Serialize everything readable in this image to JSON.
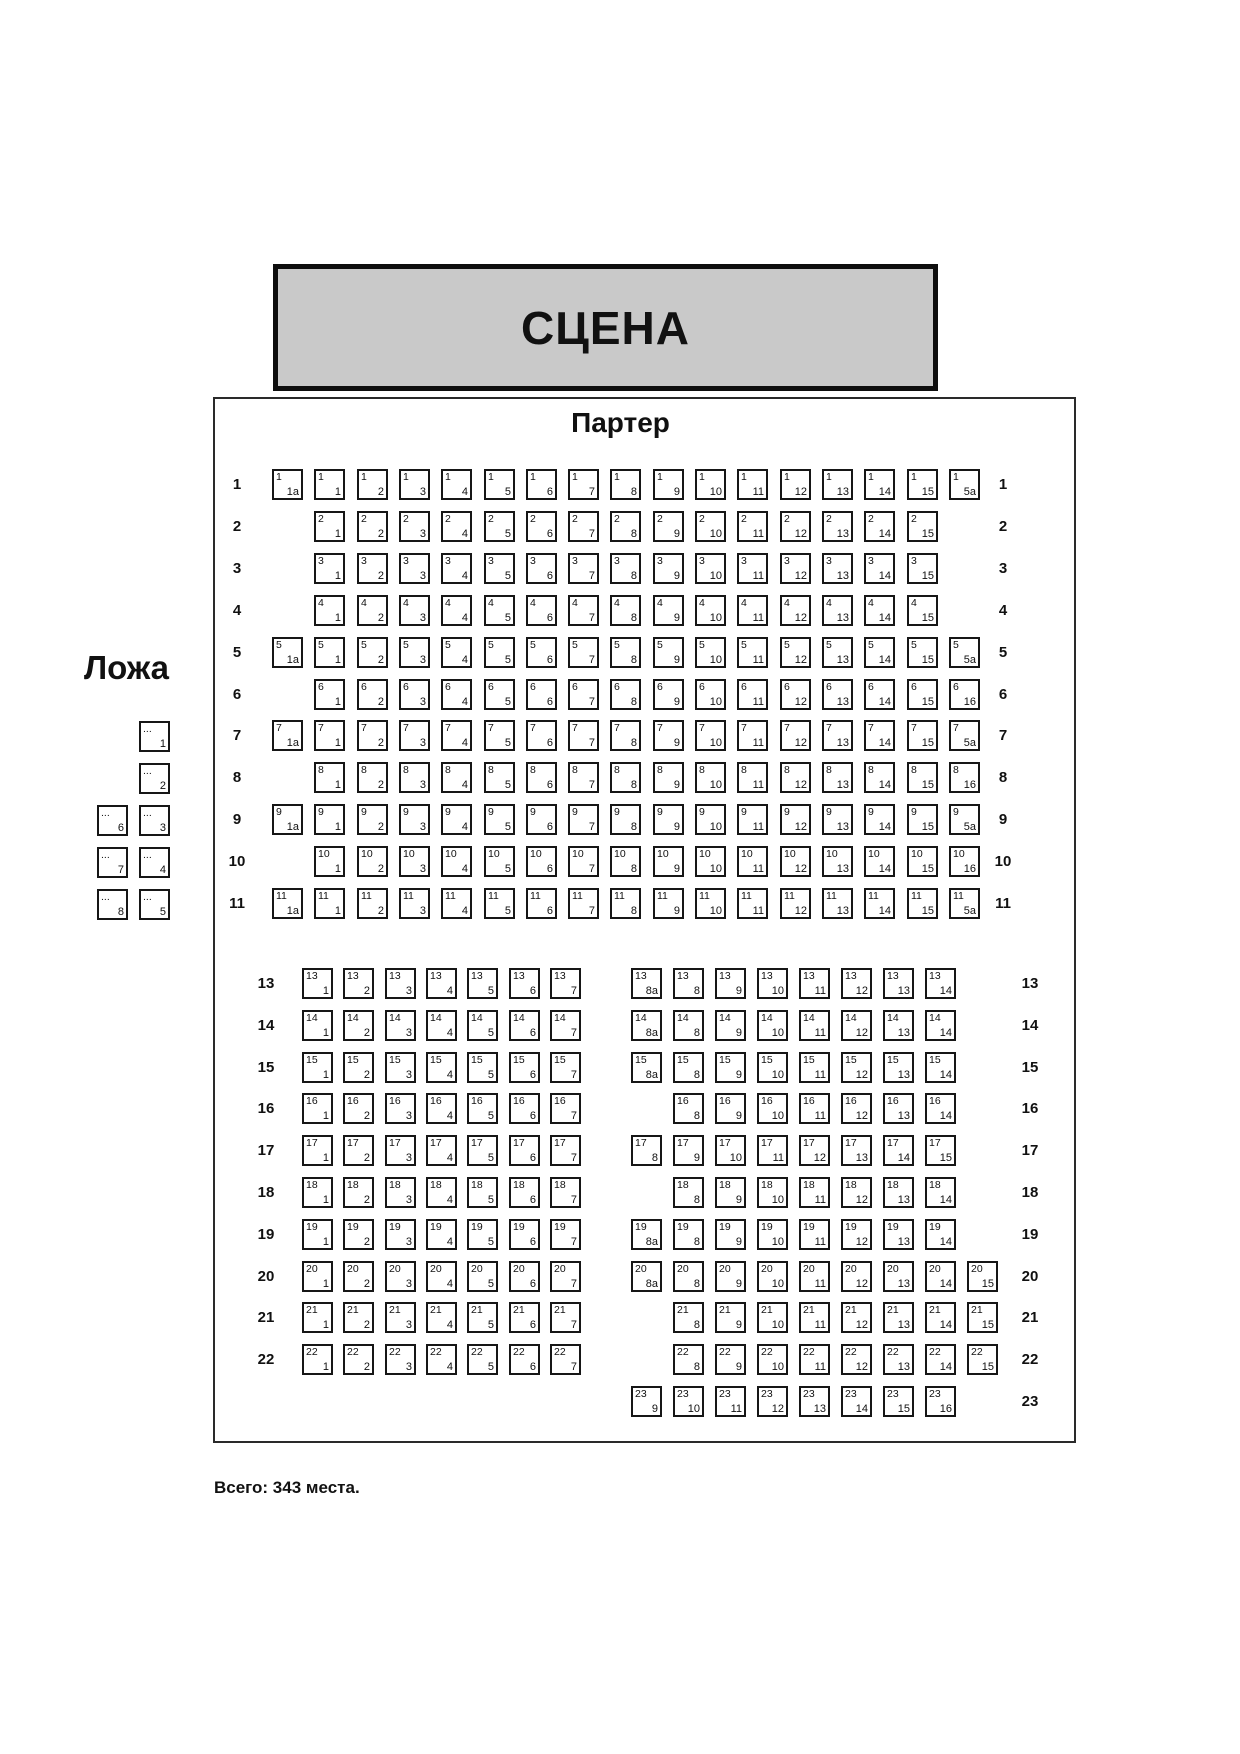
{
  "stage": {
    "label": "СЦЕНА"
  },
  "parterre": {
    "title": "Партер",
    "upper_rows": [
      {
        "label": "1",
        "start": 0,
        "seats": [
          "1a",
          "1",
          "2",
          "3",
          "4",
          "5",
          "6",
          "7",
          "8",
          "9",
          "10",
          "11",
          "12",
          "13",
          "14",
          "15",
          "5a"
        ]
      },
      {
        "label": "2",
        "start": 1,
        "seats": [
          "1",
          "2",
          "3",
          "4",
          "5",
          "6",
          "7",
          "8",
          "9",
          "10",
          "11",
          "12",
          "13",
          "14",
          "15"
        ]
      },
      {
        "label": "3",
        "start": 1,
        "seats": [
          "1",
          "2",
          "3",
          "4",
          "5",
          "6",
          "7",
          "8",
          "9",
          "10",
          "11",
          "12",
          "13",
          "14",
          "15"
        ]
      },
      {
        "label": "4",
        "start": 1,
        "seats": [
          "1",
          "2",
          "3",
          "4",
          "5",
          "6",
          "7",
          "8",
          "9",
          "10",
          "11",
          "12",
          "13",
          "14",
          "15"
        ]
      },
      {
        "label": "5",
        "start": 0,
        "seats": [
          "1a",
          "1",
          "2",
          "3",
          "4",
          "5",
          "6",
          "7",
          "8",
          "9",
          "10",
          "11",
          "12",
          "13",
          "14",
          "15",
          "5a"
        ]
      },
      {
        "label": "6",
        "start": 1,
        "seats": [
          "1",
          "2",
          "3",
          "4",
          "5",
          "6",
          "7",
          "8",
          "9",
          "10",
          "11",
          "12",
          "13",
          "14",
          "15",
          "16"
        ]
      },
      {
        "label": "7",
        "start": 0,
        "seats": [
          "1a",
          "1",
          "2",
          "3",
          "4",
          "5",
          "6",
          "7",
          "8",
          "9",
          "10",
          "11",
          "12",
          "13",
          "14",
          "15",
          "5a"
        ]
      },
      {
        "label": "8",
        "start": 1,
        "seats": [
          "1",
          "2",
          "3",
          "4",
          "5",
          "6",
          "7",
          "8",
          "9",
          "10",
          "11",
          "12",
          "13",
          "14",
          "15",
          "16"
        ]
      },
      {
        "label": "9",
        "start": 0,
        "seats": [
          "1a",
          "1",
          "2",
          "3",
          "4",
          "5",
          "6",
          "7",
          "8",
          "9",
          "10",
          "11",
          "12",
          "13",
          "14",
          "15",
          "5a"
        ]
      },
      {
        "label": "10",
        "start": 1,
        "seats": [
          "1",
          "2",
          "3",
          "4",
          "5",
          "6",
          "7",
          "8",
          "9",
          "10",
          "11",
          "12",
          "13",
          "14",
          "15",
          "16"
        ]
      },
      {
        "label": "11",
        "start": 0,
        "seats": [
          "1a",
          "1",
          "2",
          "3",
          "4",
          "5",
          "6",
          "7",
          "8",
          "9",
          "10",
          "11",
          "12",
          "13",
          "14",
          "15",
          "5a"
        ]
      }
    ],
    "lower_rows": [
      {
        "label": "13",
        "left": {
          "start": 0,
          "seats": [
            "1",
            "2",
            "3",
            "4",
            "5",
            "6",
            "7"
          ]
        },
        "right": {
          "start": 0,
          "seats": [
            "8a",
            "8",
            "9",
            "10",
            "11",
            "12",
            "13",
            "14"
          ]
        }
      },
      {
        "label": "14",
        "left": {
          "start": 0,
          "seats": [
            "1",
            "2",
            "3",
            "4",
            "5",
            "6",
            "7"
          ]
        },
        "right": {
          "start": 0,
          "seats": [
            "8a",
            "8",
            "9",
            "10",
            "11",
            "12",
            "13",
            "14"
          ]
        }
      },
      {
        "label": "15",
        "left": {
          "start": 0,
          "seats": [
            "1",
            "2",
            "3",
            "4",
            "5",
            "6",
            "7"
          ]
        },
        "right": {
          "start": 0,
          "seats": [
            "8a",
            "8",
            "9",
            "10",
            "11",
            "12",
            "13",
            "14"
          ]
        }
      },
      {
        "label": "16",
        "left": {
          "start": 0,
          "seats": [
            "1",
            "2",
            "3",
            "4",
            "5",
            "6",
            "7"
          ]
        },
        "right": {
          "start": 1,
          "seats": [
            "8",
            "9",
            "10",
            "11",
            "12",
            "13",
            "14"
          ]
        }
      },
      {
        "label": "17",
        "left": {
          "start": 0,
          "seats": [
            "1",
            "2",
            "3",
            "4",
            "5",
            "6",
            "7"
          ]
        },
        "right": {
          "start": 0,
          "seats": [
            "8",
            "9",
            "10",
            "11",
            "12",
            "13",
            "14",
            "15"
          ]
        }
      },
      {
        "label": "18",
        "left": {
          "start": 0,
          "seats": [
            "1",
            "2",
            "3",
            "4",
            "5",
            "6",
            "7"
          ]
        },
        "right": {
          "start": 1,
          "seats": [
            "8",
            "9",
            "10",
            "11",
            "12",
            "13",
            "14"
          ]
        }
      },
      {
        "label": "19",
        "left": {
          "start": 0,
          "seats": [
            "1",
            "2",
            "3",
            "4",
            "5",
            "6",
            "7"
          ]
        },
        "right": {
          "start": 0,
          "seats": [
            "8a",
            "8",
            "9",
            "10",
            "11",
            "12",
            "13",
            "14"
          ]
        }
      },
      {
        "label": "20",
        "left": {
          "start": 0,
          "seats": [
            "1",
            "2",
            "3",
            "4",
            "5",
            "6",
            "7"
          ]
        },
        "right": {
          "start": 0,
          "seats": [
            "8a",
            "8",
            "9",
            "10",
            "11",
            "12",
            "13",
            "14",
            "15"
          ]
        }
      },
      {
        "label": "21",
        "left": {
          "start": 0,
          "seats": [
            "1",
            "2",
            "3",
            "4",
            "5",
            "6",
            "7"
          ]
        },
        "right": {
          "start": 1,
          "seats": [
            "8",
            "9",
            "10",
            "11",
            "12",
            "13",
            "14",
            "15"
          ]
        }
      },
      {
        "label": "22",
        "left": {
          "start": 0,
          "seats": [
            "1",
            "2",
            "3",
            "4",
            "5",
            "6",
            "7"
          ]
        },
        "right": {
          "start": 1,
          "seats": [
            "8",
            "9",
            "10",
            "11",
            "12",
            "13",
            "14",
            "15"
          ]
        }
      },
      {
        "label": "23",
        "right": {
          "start": 0,
          "seats": [
            "9",
            "10",
            "11",
            "12",
            "13",
            "14",
            "15",
            "16"
          ]
        }
      }
    ]
  },
  "loge": {
    "title": "Ложа",
    "corner_tag": "...",
    "seats": [
      {
        "n": "1",
        "col": 1,
        "row": 0
      },
      {
        "n": "2",
        "col": 1,
        "row": 1
      },
      {
        "n": "6",
        "col": 0,
        "row": 2
      },
      {
        "n": "3",
        "col": 1,
        "row": 2
      },
      {
        "n": "7",
        "col": 0,
        "row": 3
      },
      {
        "n": "4",
        "col": 1,
        "row": 3
      },
      {
        "n": "8",
        "col": 0,
        "row": 4
      },
      {
        "n": "5",
        "col": 1,
        "row": 4
      }
    ]
  },
  "footer": {
    "total_note": "Всего: 343 места."
  }
}
